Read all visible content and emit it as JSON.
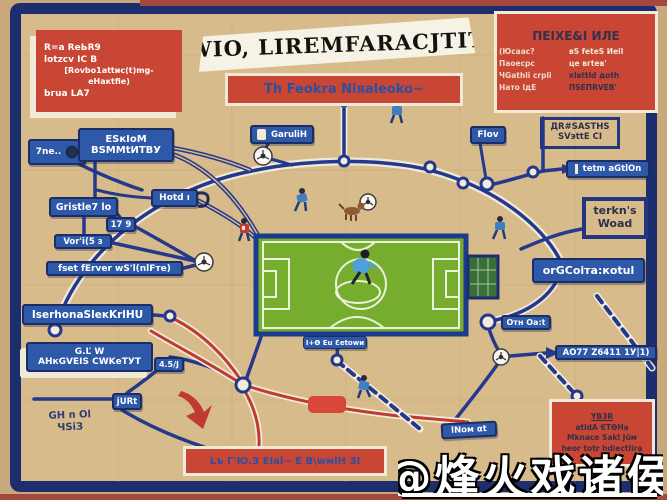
{
  "colors": {
    "background": "#d8bb8b",
    "frame": "#1d2e6e",
    "node_blue": "#2e58a8",
    "accent_red": "#c94634",
    "field_green": "#76ad2f",
    "line_navy": "#24398c",
    "line_red": "#bf3a30",
    "banner": "#f6f2e6"
  },
  "banner": {
    "text": "WIO, LIREMFARACJTIT"
  },
  "subtitle": {
    "text": "Th Feokra Niяaleoko~"
  },
  "top_left_box": {
    "l1": "R=a ReЬR9",
    "l2": "lotzcv ІС В",
    "l3": "[Rovbo1attиc(t)mg-eНaкtfiе)",
    "l4": "bгuа LА7"
  },
  "top_right_box": {
    "title": "ПЕІХЕ&І ИЛЕ",
    "r1l": "(Юсаас?",
    "r1r": "вЅ fеtеЅ Иeil",
    "r2l": "Паоесрс",
    "r2r": "це вгtев'",
    "r3l": "ЧGаthlі сrplі",
    "r3r": "кlвttld доth",
    "r4l": "Нато lдЕ",
    "r4r": "ПЅЕПRVЕВ'"
  },
  "labels": {
    "tne": "7ne..",
    "eskiom1": "ЕЅкІоМ",
    "eskiom2": "ВЅММtИТВУ",
    "garulih": "GаruliН",
    "hotd": "Hotd ı",
    "gristle": "Gristle7 lo",
    "n179": "17 9",
    "vori": "Vor'i(5 з",
    "fset": "fset fErver wЅ'l(nlFте)",
    "iserhona": "IserhonaЅlекKrlНU",
    "bigleft1": "G.Ľ W",
    "bigleft2": "AНкGVЕІЅ CWKеТУТ",
    "jurt": "jURt",
    "n45j": "4.5/J",
    "bgtext1": "GН п Оl",
    "bgtext2": "ЧЅіЗ",
    "flov": "Flov",
    "dr1": "ДR#ЅАЅТНЅ",
    "dr2": "ЅVэttЕ СІ",
    "tetm": "tеtm аGtlOn",
    "terkns1": "tеrkn's",
    "terkns2": "Woad",
    "orgcoi": "orGCoiта:коtul",
    "orn": "Отн Оа:t",
    "ao77": "АО77 Z6411 1У|1)",
    "lnom": "lΝoм αt",
    "fieldlabel": "І+Ѳ Еu Ɛеtоwи"
  },
  "bottom_banner": {
    "text": "Lъ Г'Ю.З ЕІаl~ Е В\\wмlН ЗІ"
  },
  "bottom_right_box": {
    "l1": "YВЗR",
    "l2": "аtidА ЄТѲНа",
    "l3": "Mknace Sakl Jüм",
    "l4": "heor totr hdiectlira"
  },
  "watermark": {
    "text": "@烽火戏诸侯"
  },
  "icons": {
    "soccer_ball": "ball-circle",
    "goal": "goal-grid",
    "whistle": "curl",
    "red_arrow": "curved-arrow",
    "players": "player-silhouettes",
    "dog": "dog-silhouette"
  }
}
